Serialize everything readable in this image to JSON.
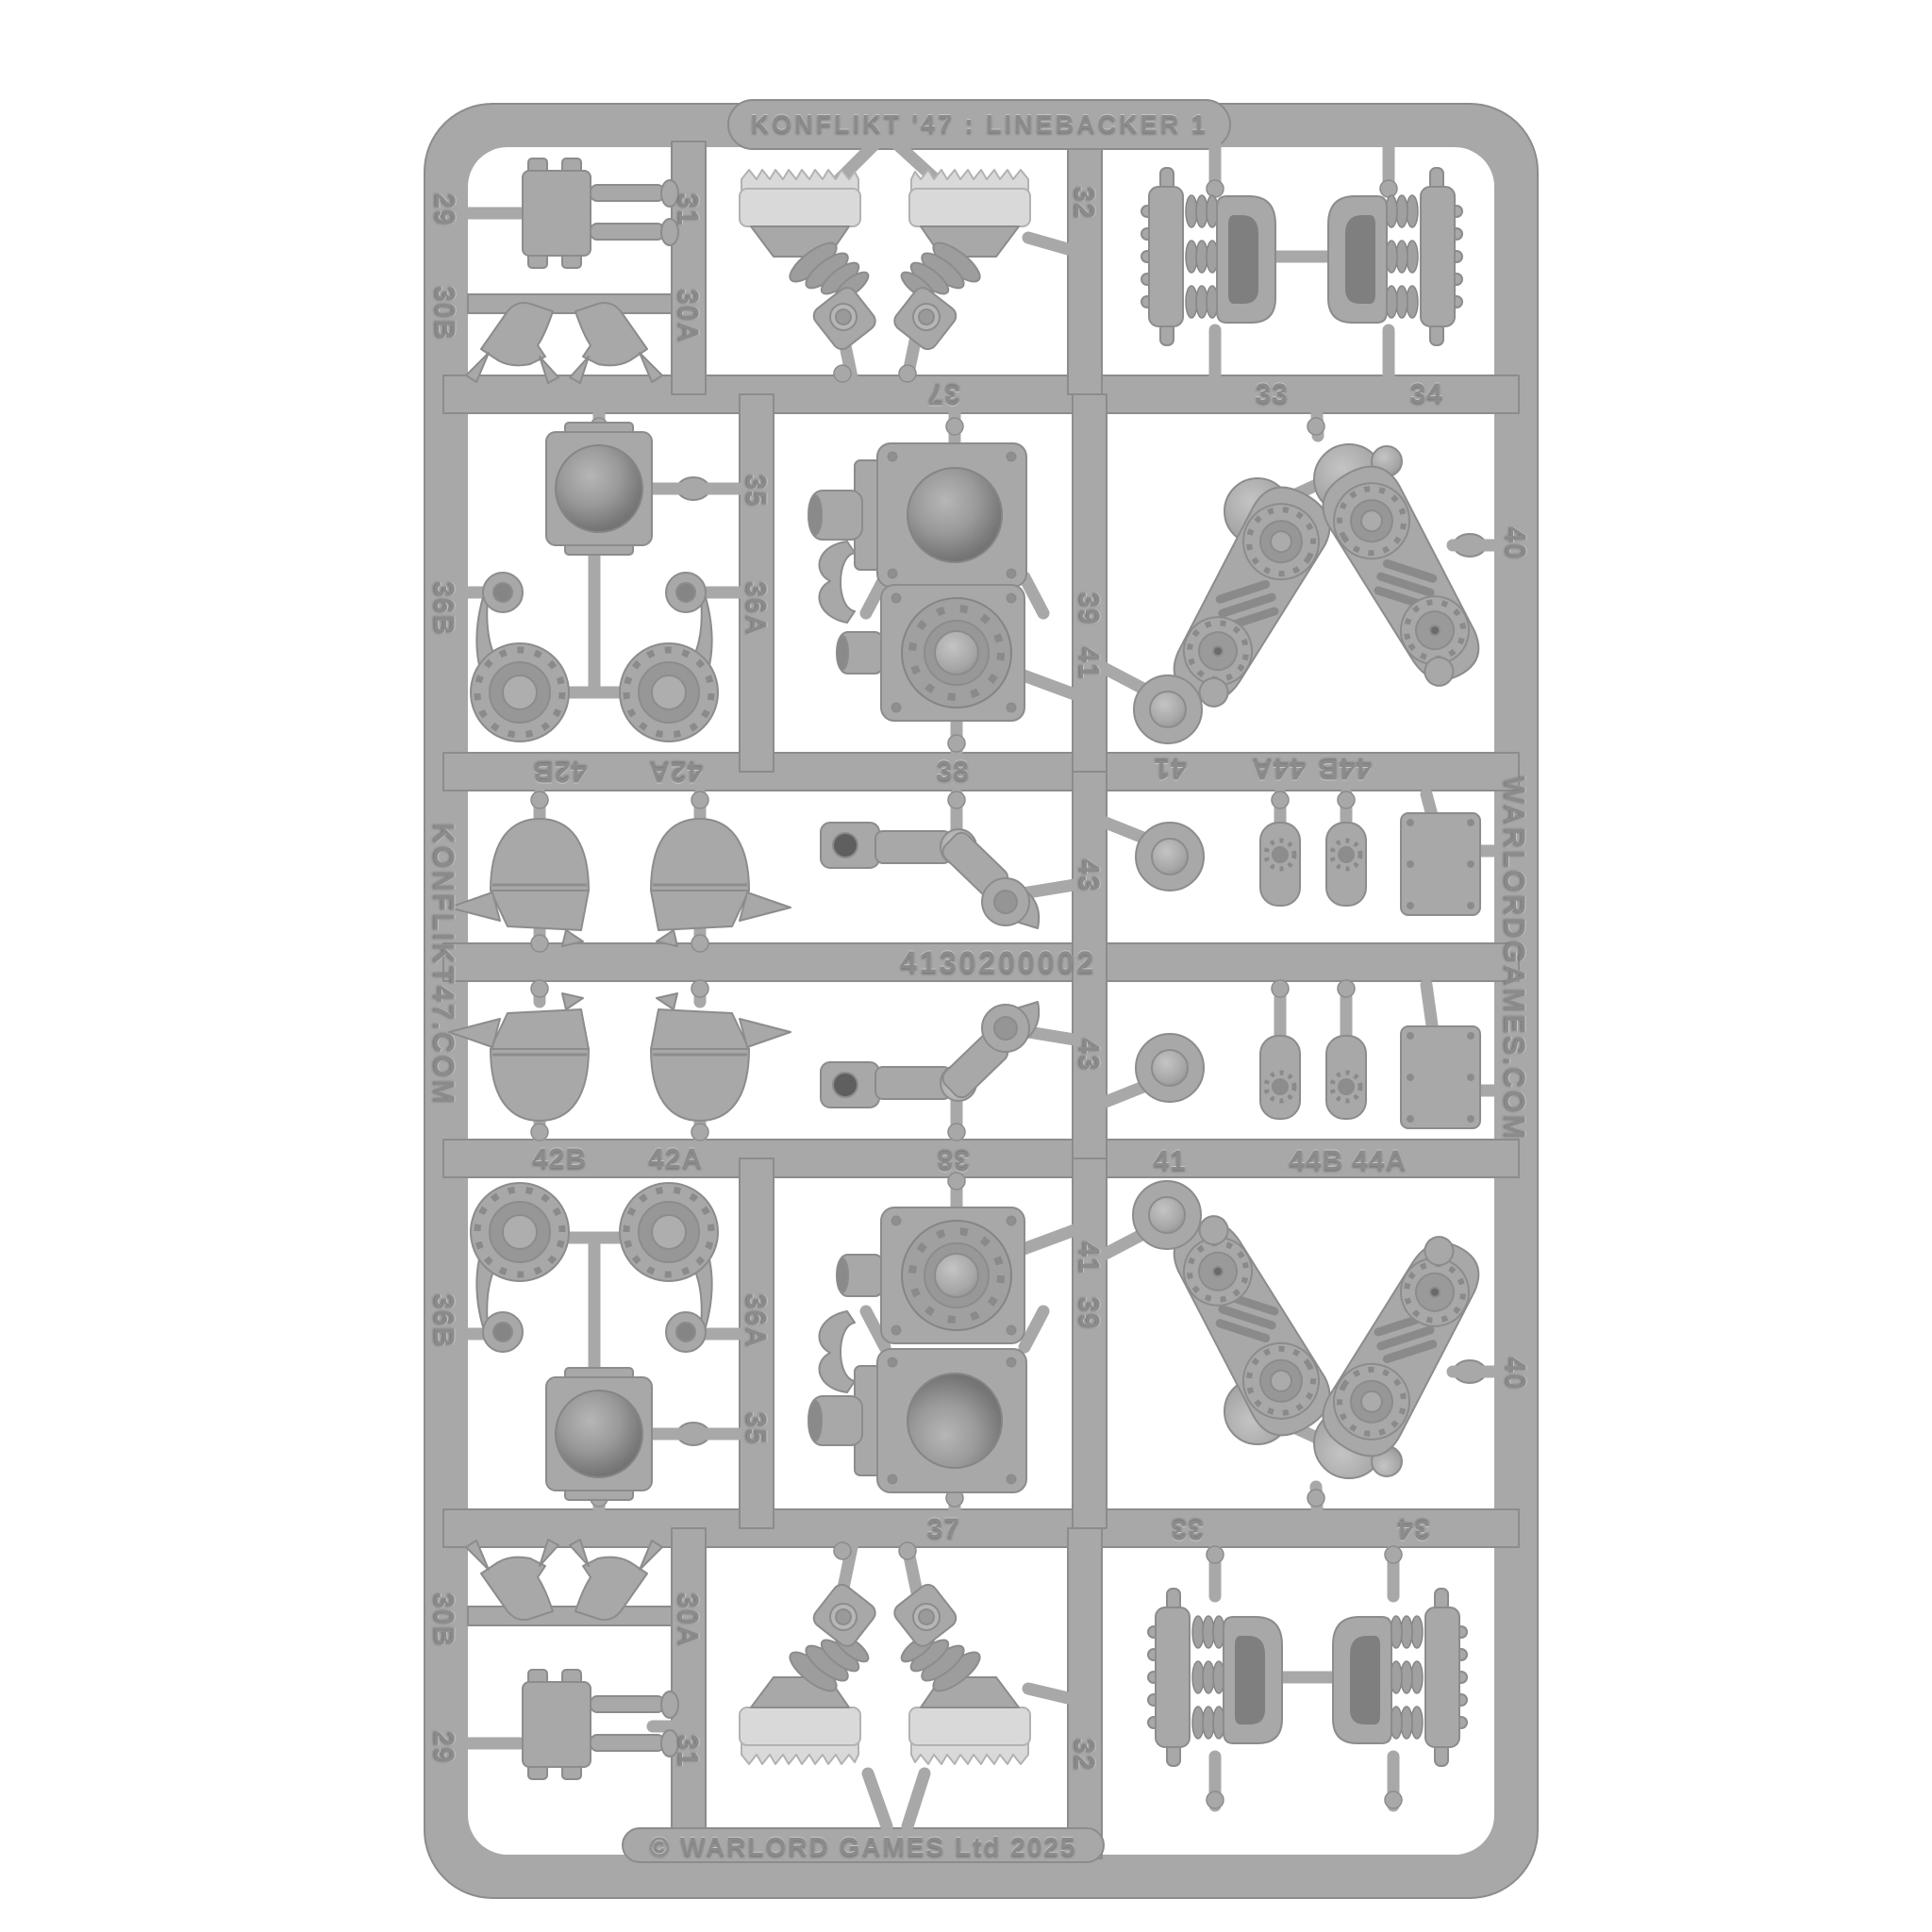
{
  "product": {
    "title": "KONFLIKT '47 : LINEBACKER 1",
    "copyright": "© WARLORD GAMES Ltd 2025",
    "sku": "4130200002",
    "left_rail_text": "KONFLIKT47.COM",
    "right_rail_text": "WARLORDGAMES.COM"
  },
  "colors": {
    "background": "#ffffff",
    "plastic": "#a8a8a8",
    "plastic_shadow": "#8c8c8c",
    "plastic_light": "#c6c6c6",
    "tread_plate": "#d9d9d9"
  },
  "labels": [
    "29",
    "30B",
    "31",
    "30A",
    "32",
    "37",
    "33",
    "34",
    "36B",
    "35",
    "36A",
    "39",
    "41",
    "40",
    "42B",
    "42A",
    "38",
    "41",
    "44A",
    "44B",
    "43",
    "43",
    "42B",
    "42A",
    "38",
    "41",
    "44B",
    "44A",
    "36B",
    "36A",
    "35",
    "41",
    "39",
    "40",
    "37",
    "33",
    "34",
    "30B",
    "30A",
    "29",
    "31",
    "32"
  ]
}
